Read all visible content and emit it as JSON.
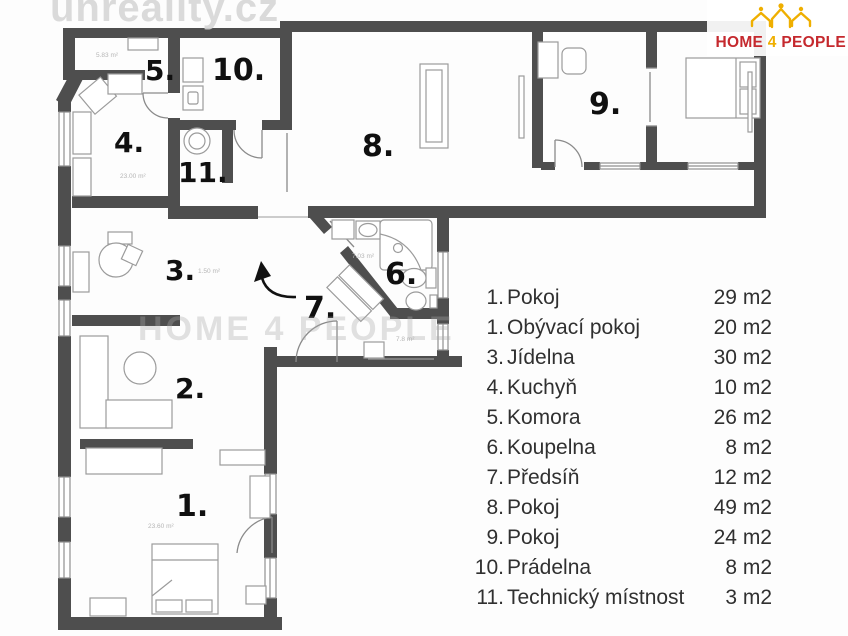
{
  "watermarks": {
    "top_left": "unreality.cz",
    "middle": "HOME 4 PEOPLE"
  },
  "logo": {
    "word1": "HOME",
    "word2": "4",
    "word3": "PEOPLE",
    "icon": "three-gold-houses-with-people-icon"
  },
  "colors": {
    "wall": "#4e4e4e",
    "furniture_outline": "#9b9b9b",
    "logo_red": "#c5292e",
    "logo_gold": "#efaf00",
    "tiny_text": "#b5b5b5",
    "label_text": "#101010"
  },
  "floorplan": {
    "room_labels": [
      {
        "label": "1.",
        "x": 176,
        "y": 516,
        "size": 30
      },
      {
        "label": "2.",
        "x": 175,
        "y": 398,
        "size": 28
      },
      {
        "label": "3.",
        "x": 165,
        "y": 280,
        "size": 28
      },
      {
        "label": "4.",
        "x": 114,
        "y": 152,
        "size": 28
      },
      {
        "label": "5.",
        "x": 145,
        "y": 80,
        "size": 28
      },
      {
        "label": "6.",
        "x": 385,
        "y": 284,
        "size": 30
      },
      {
        "label": "7.",
        "x": 304,
        "y": 318,
        "size": 30
      },
      {
        "label": "8.",
        "x": 362,
        "y": 156,
        "size": 30
      },
      {
        "label": "9.",
        "x": 589,
        "y": 114,
        "size": 30
      },
      {
        "label": "10.",
        "x": 212,
        "y": 80,
        "size": 30
      },
      {
        "label": "11.",
        "x": 178,
        "y": 182,
        "size": 28
      }
    ],
    "area_texts": [
      {
        "text": "5.83 m²",
        "x": 96,
        "y": 57
      },
      {
        "text": "23.00 m²",
        "x": 120,
        "y": 178
      },
      {
        "text": "1.50 m²",
        "x": 198,
        "y": 273
      },
      {
        "text": "7.03 m²",
        "x": 352,
        "y": 258
      },
      {
        "text": "7.8 m²",
        "x": 396,
        "y": 341
      },
      {
        "text": "23.60 m²",
        "x": 148,
        "y": 528
      }
    ]
  },
  "legend": {
    "rows": [
      {
        "num": "1.",
        "name": "Pokoj",
        "area": "29 m2"
      },
      {
        "num": "1.",
        "name": "Obývací pokoj",
        "area": "20 m2"
      },
      {
        "num": "3.",
        "name": "Jídelna",
        "area": "30 m2"
      },
      {
        "num": "4.",
        "name": "Kuchyň",
        "area": "10 m2"
      },
      {
        "num": "5.",
        "name": "Komora",
        "area": "26 m2"
      },
      {
        "num": "6.",
        "name": "Koupelna",
        "area": "8 m2"
      },
      {
        "num": "7.",
        "name": "Předsíň",
        "area": "12 m2"
      },
      {
        "num": "8.",
        "name": "Pokoj",
        "area": "49 m2"
      },
      {
        "num": "9.",
        "name": "Pokoj",
        "area": "24 m2"
      },
      {
        "num": "10.",
        "name": "Prádelna",
        "area": "8 m2"
      },
      {
        "num": "11.",
        "name": "Technický místnost",
        "area": "3 m2"
      }
    ]
  }
}
